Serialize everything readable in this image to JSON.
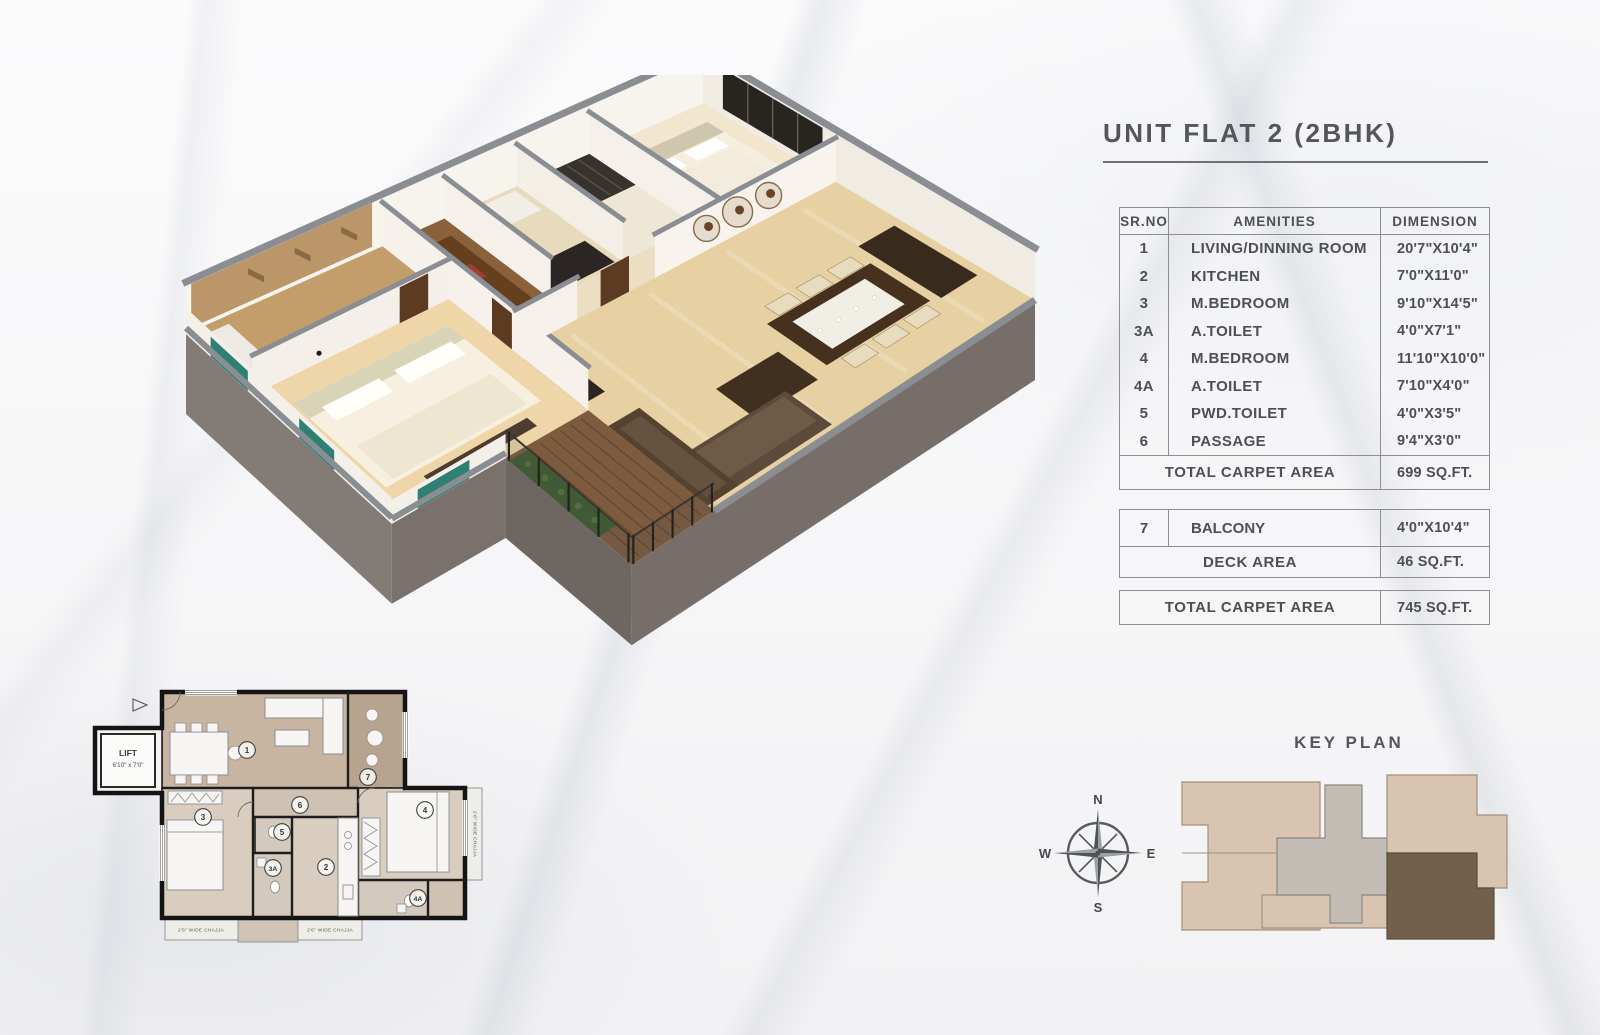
{
  "title": "UNIT FLAT 2 (2BHK)",
  "amenities_table": {
    "headers": {
      "sr": "SR.NO",
      "amenities": "AMENITIES",
      "dimension": "DIMENSION"
    },
    "rows": [
      {
        "sr": "1",
        "name": "LIVING/DINNING ROOM",
        "dim": "20'7\"X10'4\""
      },
      {
        "sr": "2",
        "name": "KITCHEN",
        "dim": "7'0\"X11'0\""
      },
      {
        "sr": "3",
        "name": "M.BEDROOM",
        "dim": "9'10\"X14'5\""
      },
      {
        "sr": "3A",
        "name": "A.TOILET",
        "dim": "4'0\"X7'1\""
      },
      {
        "sr": "4",
        "name": "M.BEDROOM",
        "dim": "11'10\"X10'0\""
      },
      {
        "sr": "4A",
        "name": "A.TOILET",
        "dim": "7'10\"X4'0\""
      },
      {
        "sr": "5",
        "name": "PWD.TOILET",
        "dim": "4'0\"X3'5\""
      },
      {
        "sr": "6",
        "name": "PASSAGE",
        "dim": "9'4\"X3'0\""
      }
    ],
    "total_label": "TOTAL CARPET AREA",
    "total_value": "699 SQ.FT."
  },
  "balcony_table": {
    "row": {
      "sr": "7",
      "name": "BALCONY",
      "dim": "4'0\"X10'4\""
    },
    "deck_label": "DECK AREA",
    "deck_value": "46 SQ.FT."
  },
  "grand_total": {
    "label": "TOTAL CARPET AREA",
    "value": "745 SQ.FT."
  },
  "key_plan": {
    "title": "KEY PLAN"
  },
  "compass": {
    "n": "N",
    "e": "E",
    "s": "S",
    "w": "W"
  },
  "plan2d": {
    "lift_label": "LIFT",
    "lift_dim": "6'10\" x 7'0\"",
    "rooms": [
      {
        "num": "1"
      },
      {
        "num": "7"
      },
      {
        "num": "3"
      },
      {
        "num": "6"
      },
      {
        "num": "5"
      },
      {
        "num": "3A"
      },
      {
        "num": "2"
      },
      {
        "num": "4"
      },
      {
        "num": "4A"
      }
    ],
    "chajja_left": "2'6\" WIDE CHAJJA",
    "chajja_mid": "2'6\" WIDE CHAJJA",
    "chajja_right": "2'6\" WIDE CHAJJA"
  },
  "colors": {
    "text": "#4e4f54",
    "wall_cap": "#8a8e93",
    "plinth": "#7a716c",
    "living_floor": "#e7d0a1",
    "deck_wood": "#7d5b3f",
    "keyplan_beige": "#d8c4b1",
    "keyplan_gray": "#c3bdb6",
    "keyplan_unit_brown": "#72604c",
    "accent_teal": "#2e7f74"
  }
}
